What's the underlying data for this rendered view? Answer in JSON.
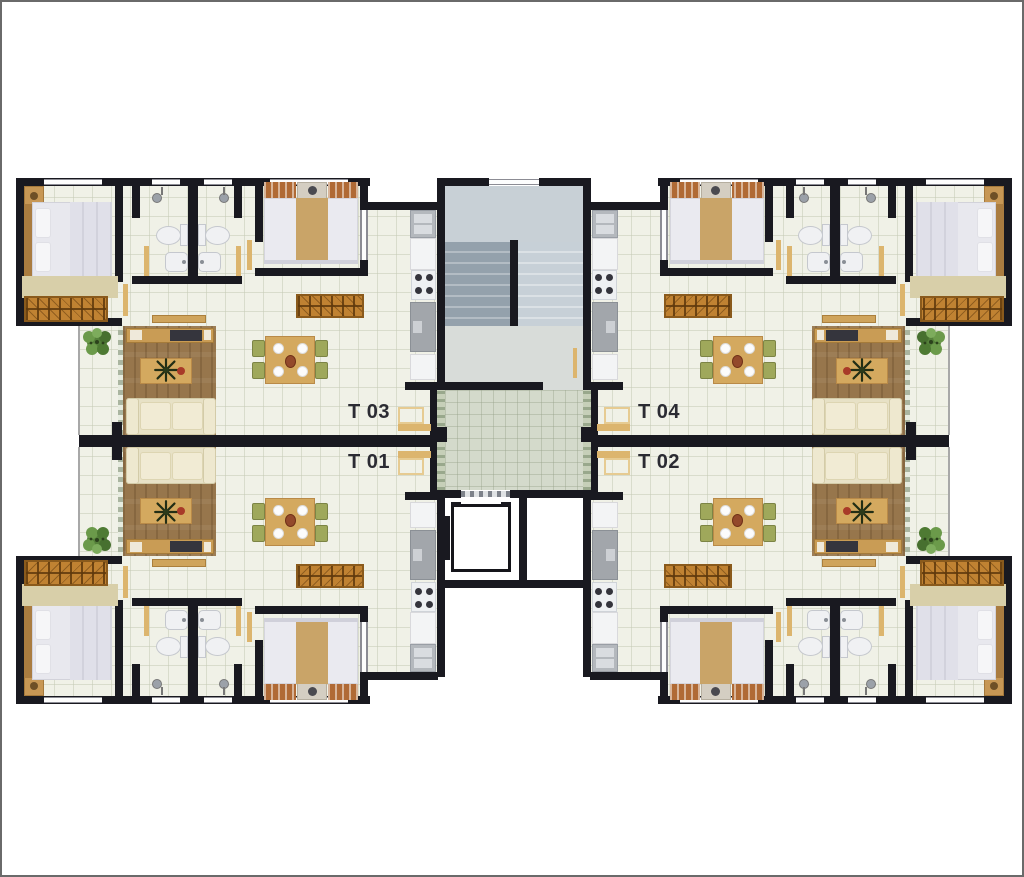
{
  "floor_plan": {
    "unit_labels": {
      "top_left": "T 03",
      "bottom_left": "T 01",
      "top_right": "T 04",
      "bottom_right": "T 02"
    },
    "colors": {
      "wall": "#191920",
      "floor_tile": "#f0f1e7",
      "wood_floor": "#97764c",
      "furniture_tan": "#d4a95f",
      "wardrobe_brown": "#c08232",
      "sofa_cream": "#e7e1c6",
      "hall_tile": "#d4dacb",
      "stair_gray": "#aab5bd",
      "door_tan": "#dcb56e",
      "plant_green": "#55803a",
      "chair_olive": "#9fa85b",
      "background": "#ffffff"
    }
  }
}
